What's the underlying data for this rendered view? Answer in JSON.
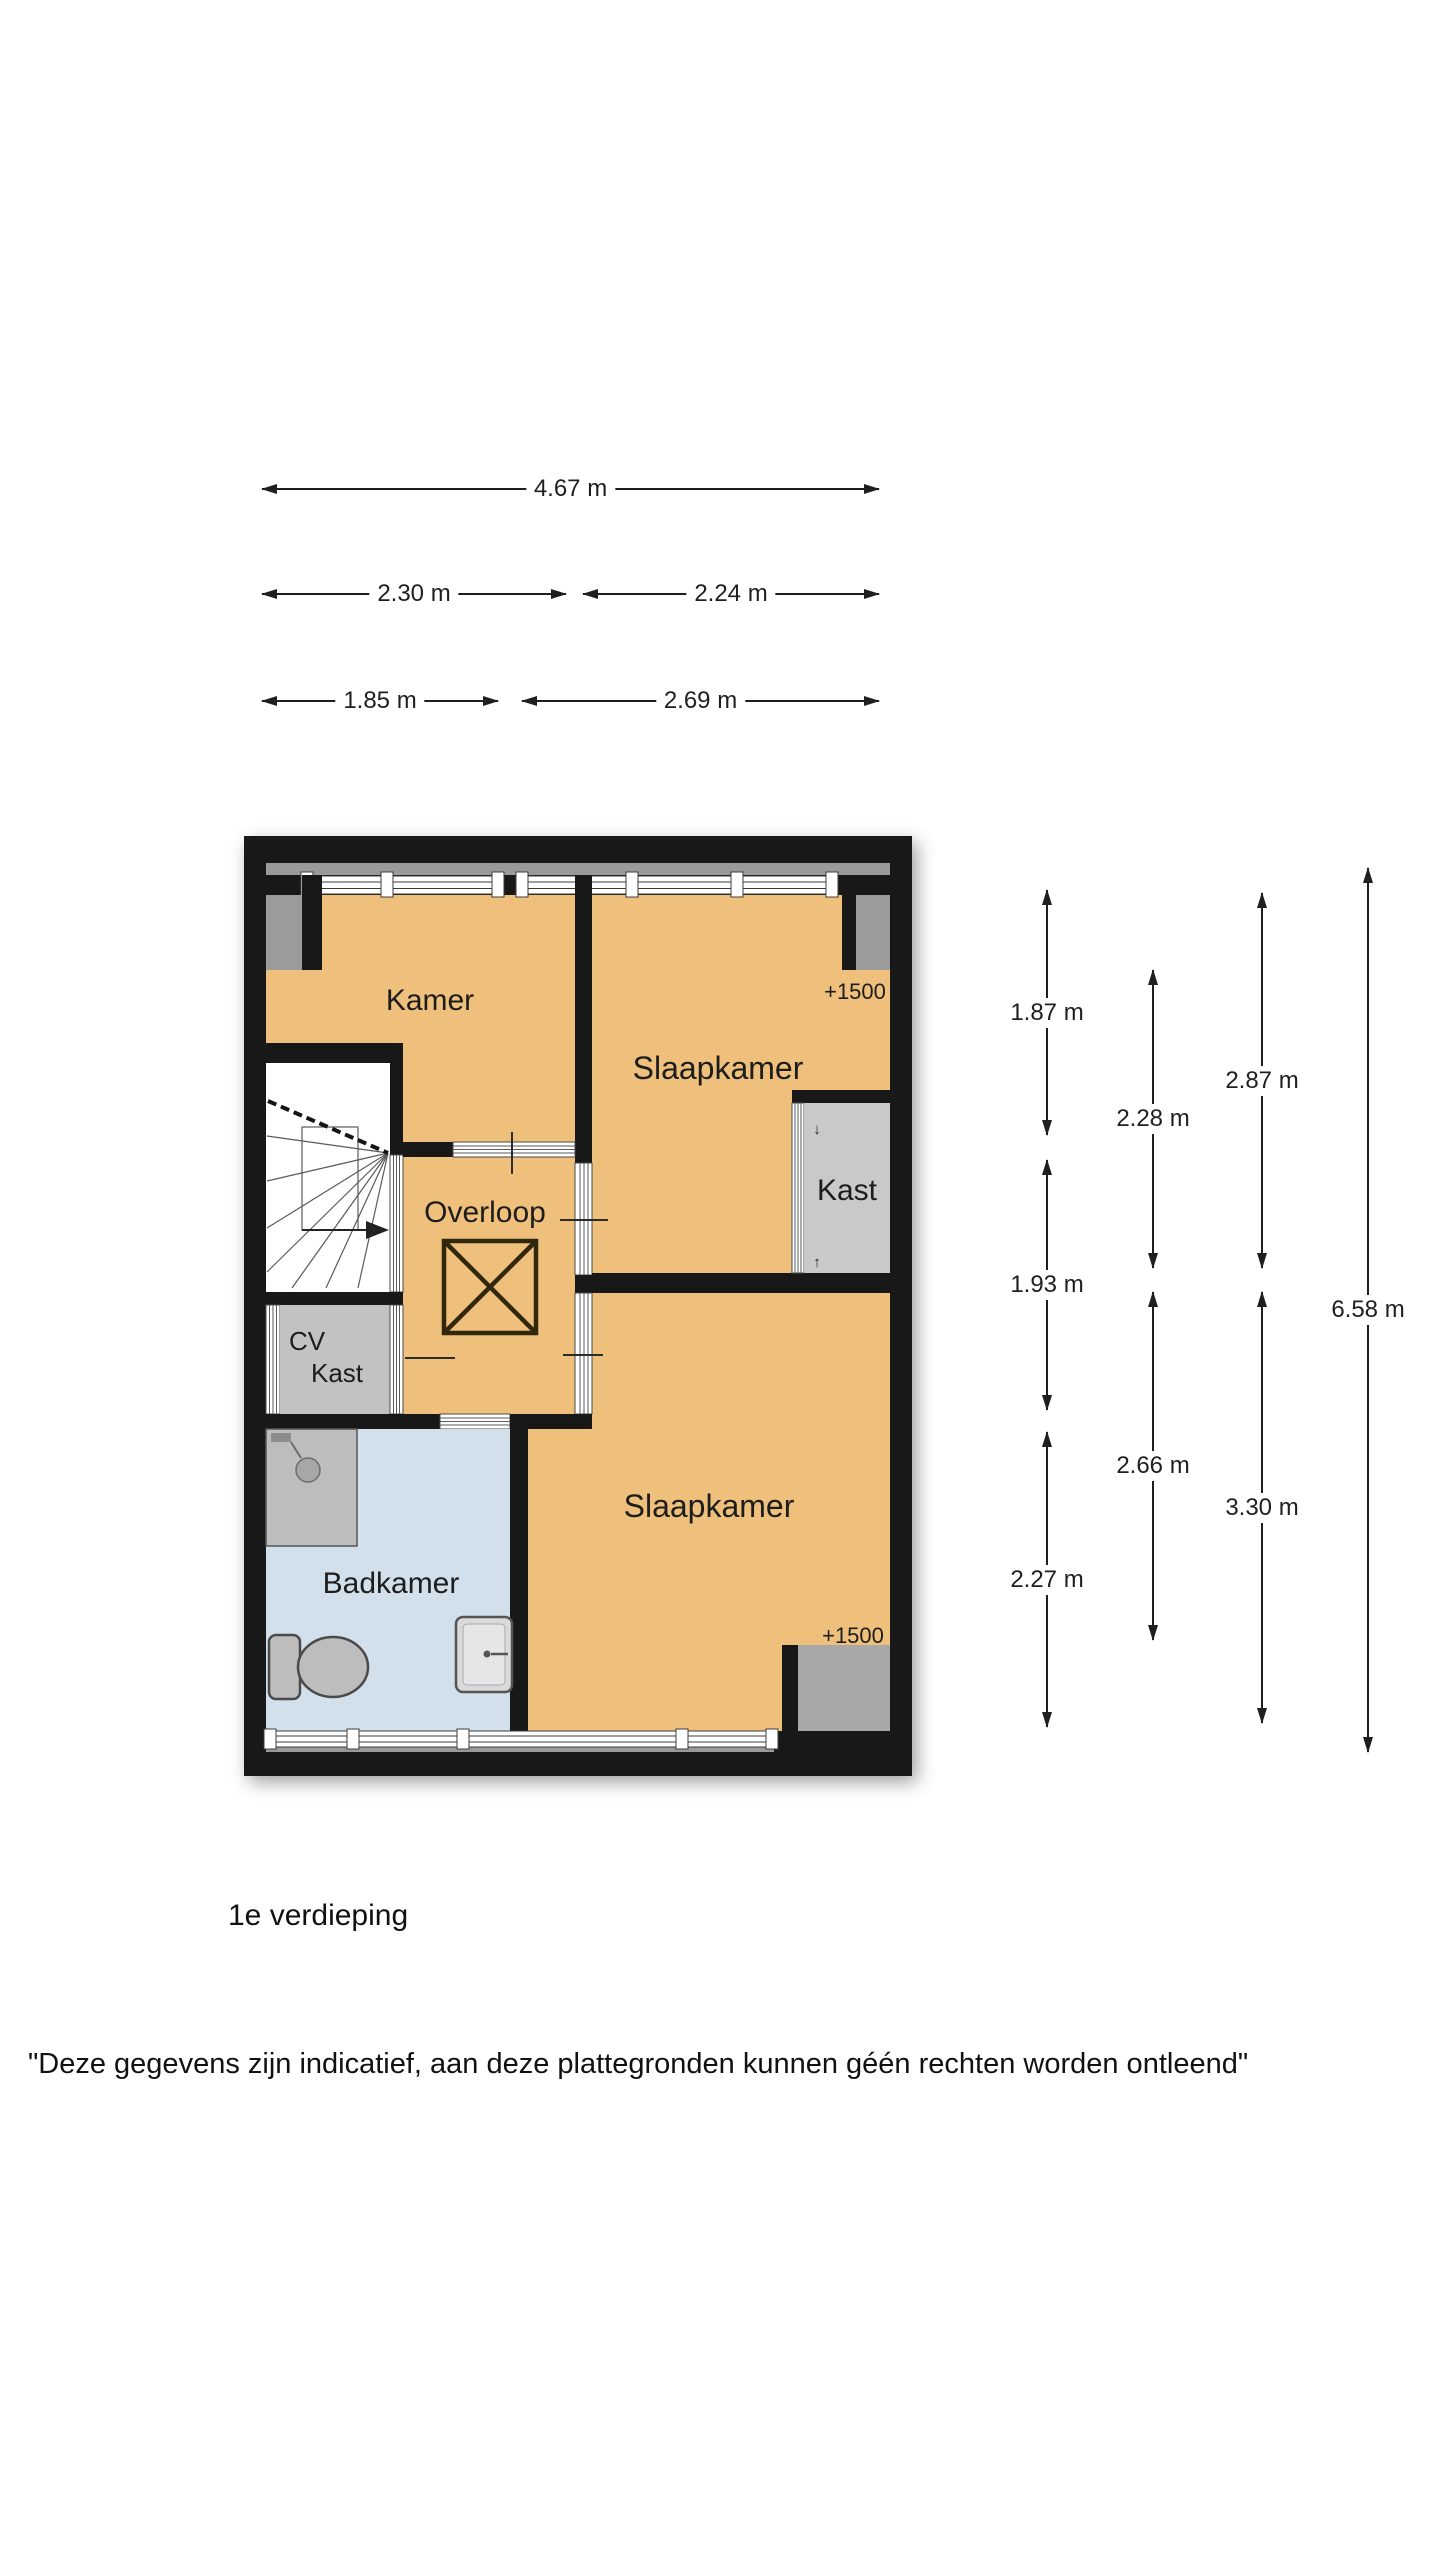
{
  "floorplan": {
    "rooms": {
      "kamer": "Kamer",
      "slaapkamer_top": "Slaapkamer",
      "slaapkamer_bottom": "Slaapkamer",
      "overloop": "Overloop",
      "kast": "Kast",
      "cv_line1": "CV",
      "cv_line2": "Kast",
      "badkamer": "Badkamer",
      "height_marker_top": "+1500",
      "height_marker_bottom": "+1500",
      "kast_arrow_down": "↓",
      "kast_arrow_up": "↑"
    },
    "colors": {
      "wall": "#181818",
      "floor": "#eec07c",
      "bath": "#d2e0ec",
      "closet": "#c9c9c9",
      "cv": "#c2c2c2",
      "pocket": "#9b9b9b",
      "strip": "#9a9a9a",
      "low": "#a8a8a8"
    }
  },
  "dimensions": {
    "top": [
      {
        "label": "4.67 m"
      },
      {
        "label": "2.30 m"
      },
      {
        "label": "2.24 m"
      },
      {
        "label": "1.85 m"
      },
      {
        "label": "2.69 m"
      }
    ],
    "right": [
      {
        "label": "1.87 m"
      },
      {
        "label": "1.93 m"
      },
      {
        "label": "2.27 m"
      },
      {
        "label": "2.28 m"
      },
      {
        "label": "2.66 m"
      },
      {
        "label": "2.87 m"
      },
      {
        "label": "3.30 m"
      },
      {
        "label": "6.58 m"
      }
    ]
  },
  "caption": "1e verdieping",
  "disclaimer": "\"Deze gegevens zijn indicatief, aan deze plattegronden kunnen géén rechten worden ontleend\""
}
